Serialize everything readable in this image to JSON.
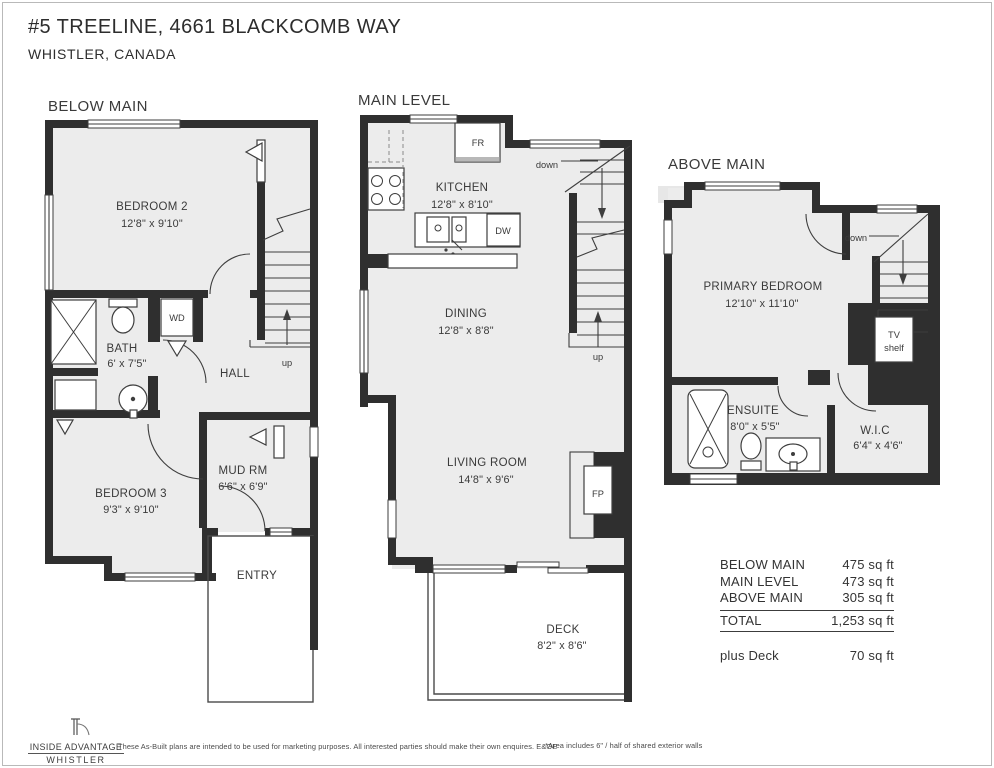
{
  "title": {
    "address": "#5 TREELINE, 4661 BLACKCOMB WAY",
    "city": "WHISTLER, CANADA"
  },
  "levels": {
    "below_main": {
      "label": "BELOW MAIN",
      "bedroom2": {
        "name": "BEDROOM 2",
        "dims": "12'8\" x 9'10\""
      },
      "bath": {
        "name": "BATH",
        "dims": "6' x 7'5\""
      },
      "hall": {
        "name": "HALL"
      },
      "mud_rm": {
        "name": "MUD RM",
        "dims": "6'6\" x 6'9\""
      },
      "bedroom3": {
        "name": "BEDROOM 3",
        "dims": "9'3\" x 9'10\""
      },
      "entry": {
        "name": "ENTRY"
      },
      "washer_dryer": "WD",
      "stairs": "up"
    },
    "main_level": {
      "label": "MAIN LEVEL",
      "kitchen": {
        "name": "KITCHEN",
        "dims": "12'8\" x 8'10\""
      },
      "dining": {
        "name": "DINING",
        "dims": "12'8\" x 8'8\""
      },
      "living_room": {
        "name": "LIVING ROOM",
        "dims": "14'8\" x 9'6\""
      },
      "deck": {
        "name": "DECK",
        "dims": "8'2\" x 8'6\""
      },
      "fridge": "FR",
      "dishwasher": "DW",
      "fireplace": "FP",
      "stairs_down": "down",
      "stairs_up": "up"
    },
    "above_main": {
      "label": "ABOVE MAIN",
      "primary_bedroom": {
        "name": "PRIMARY BEDROOM",
        "dims": "12'10\" x 11'10\""
      },
      "ensuite": {
        "name": "ENSUITE",
        "dims": "8'0\" x 5'5\""
      },
      "wic": {
        "name": "W.I.C",
        "dims": "6'4\" x 4'6\""
      },
      "tv_shelf": {
        "line1": "TV",
        "line2": "shelf"
      },
      "stairs": "down"
    }
  },
  "area_table": {
    "rows": [
      {
        "label": "BELOW MAIN",
        "value": "475 sq ft"
      },
      {
        "label": "MAIN LEVEL",
        "value": "473 sq ft"
      },
      {
        "label": "ABOVE MAIN",
        "value": "305 sq ft"
      }
    ],
    "total": {
      "label": "TOTAL",
      "value": "1,253 sq ft"
    },
    "deck_row": {
      "label": "plus Deck",
      "value": "70 sq ft"
    }
  },
  "footer": {
    "logo": {
      "line1": "INSIDE ADVANTAGE",
      "line2": "WHISTLER"
    },
    "disclaimer": "These As-Built plans are intended to be used for marketing purposes. All interested parties should make their own enquires. E&OE",
    "note": "*Area includes 6\" / half of shared exterior walls"
  }
}
